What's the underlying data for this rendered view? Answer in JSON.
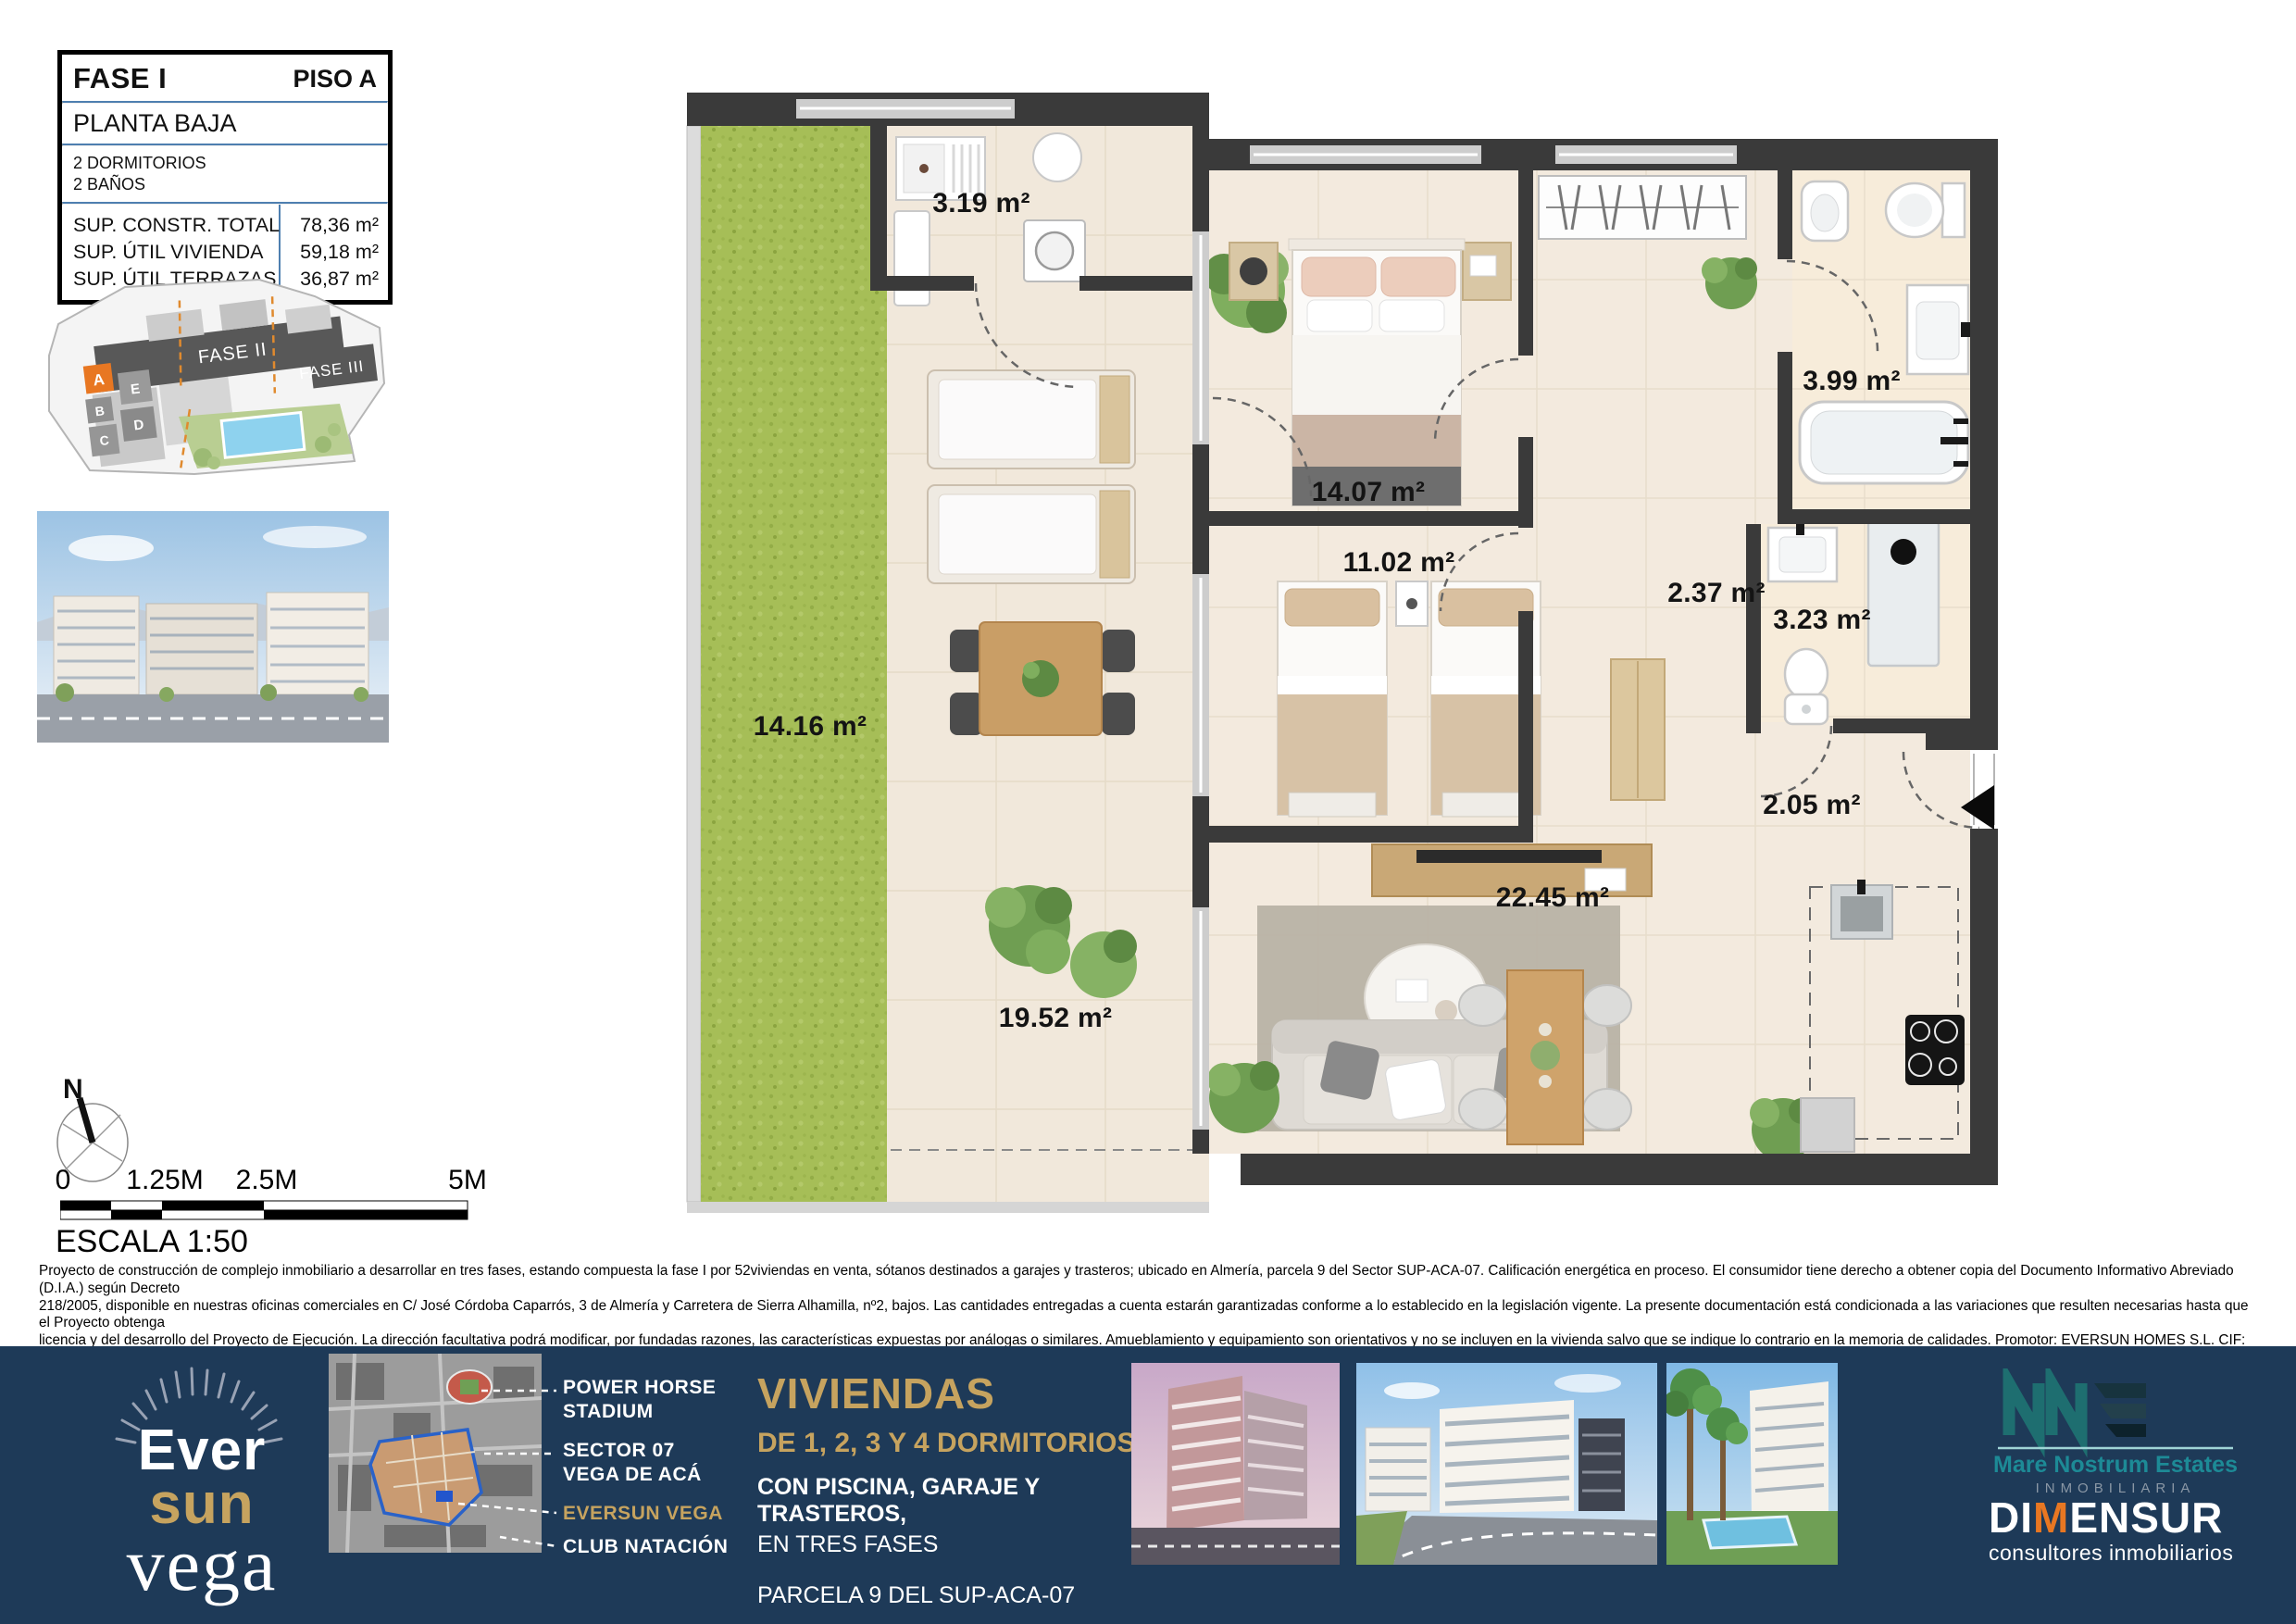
{
  "info_box": {
    "fase": "FASE I",
    "piso": "PISO A",
    "planta": "PLANTA BAJA",
    "bed_count": "2 DORMITORIOS",
    "bath_count": "2 BAÑOS",
    "rows": [
      {
        "label": "SUP. CONSTR. TOTAL",
        "value": "78,36 m²"
      },
      {
        "label": "SUP. ÚTIL VIVIENDA",
        "value": "59,18 m²"
      },
      {
        "label": "SUP. ÚTIL TERRAZAS",
        "value": "36,87 m²"
      }
    ]
  },
  "site_plan": {
    "fase2": "FASE II",
    "fase3": "FASE III",
    "block_a": "A",
    "block_b": "B",
    "block_c": "C",
    "block_d": "D",
    "block_e": "E"
  },
  "plan": {
    "rooms": [
      {
        "id": "laundry",
        "area": "3.19 m²"
      },
      {
        "id": "bedroom-main",
        "area": "14.07 m²"
      },
      {
        "id": "bedroom-2",
        "area": "11.02 m²"
      },
      {
        "id": "bathroom-1",
        "area": "3.99 m²"
      },
      {
        "id": "hall-1",
        "area": "2.37 m²"
      },
      {
        "id": "bathroom-2",
        "area": "3.23 m²"
      },
      {
        "id": "hall-entry",
        "area": "2.05 m²"
      },
      {
        "id": "living-kitchen",
        "area": "22.45 m²"
      },
      {
        "id": "terrace",
        "area": "19.52 m²"
      },
      {
        "id": "garden",
        "area": "14.16 m²"
      }
    ]
  },
  "compass": {
    "north": "N"
  },
  "scale_bar": {
    "t0": "0",
    "t1": "1.25M",
    "t2": "2.5M",
    "t3": "5M",
    "escala": "ESCALA 1:50"
  },
  "legal": {
    "l1": "Proyecto de construcción de complejo inmobiliario a desarrollar en tres fases, estando compuesta la fase I por 52viviendas en venta, sótanos destinados a garajes y trasteros; ubicado en Almería, parcela 9 del Sector SUP-ACA-07. Calificación energética en proceso. El consumidor tiene derecho a obtener copia del Documento Informativo Abreviado (D.I.A.) según Decreto",
    "l2": "218/2005, disponible en nuestras oficinas comerciales en C/ José Córdoba Caparrós, 3 de Almería y Carretera de Sierra Alhamilla, nº2, bajos. Las cantidades entregadas a cuenta estarán garantizadas conforme a lo establecido en la legislación vigente. La presente documentación está condicionada a las variaciones que resulten necesarias hasta que el Proyecto obtenga",
    "l3": "licencia y del desarrollo del Proyecto de Ejecución. La dirección facultativa podrá modificar, por fundadas razones, las características expuestas por análogas o similares. Amueblamiento y equipamiento son orientativos y no se incluyen en la vivienda salvo que se indique lo contrario en la memoria de calidades. Promotor: EVERSUN HOMES S.L. CIF: B-56244015, Comercializan:",
    "l4": "Dimensur, SL. CIF:B-04490587 y Mare Nostrum Estates, S.L. CIF:B-04683280."
  },
  "footer": {
    "logo": {
      "ever": "Ever",
      "sun": "sun",
      "vega": "vega"
    },
    "callouts": {
      "c1a": "POWER HORSE",
      "c1b": "STADIUM",
      "c2a": "SECTOR 07",
      "c2b": "VEGA DE ACÁ",
      "c3": "EVERSUN VEGA",
      "c4": "CLUB NATACIÓN"
    },
    "promo": {
      "title": "VIVIENDAS",
      "line2": "DE 1, 2, 3 Y 4 DORMITORIOS,",
      "line3": "CON PISCINA, GARAJE Y TRASTEROS,",
      "line4": "EN TRES FASES",
      "line5": "PARCELA 9 DEL SUP-ACA-07",
      "planos": "Planos",
      "fase": "FASE I",
      "de": "de",
      "brand": "EVERSUN VEGA"
    },
    "mne": {
      "name": "Mare Nostrum Estates",
      "sub": "INMOBILIARIA"
    },
    "dimensur": {
      "p1": "DI",
      "p2": "M",
      "p3": "ENSUR",
      "sub": "consultores inmobiliarios"
    }
  },
  "colors": {
    "navy": "#1e3a58",
    "gold": "#c6a35f",
    "wall": "#3a3a3a",
    "grass": "#a6be57",
    "orange": "#e87722",
    "teal": "#1d8a96"
  }
}
